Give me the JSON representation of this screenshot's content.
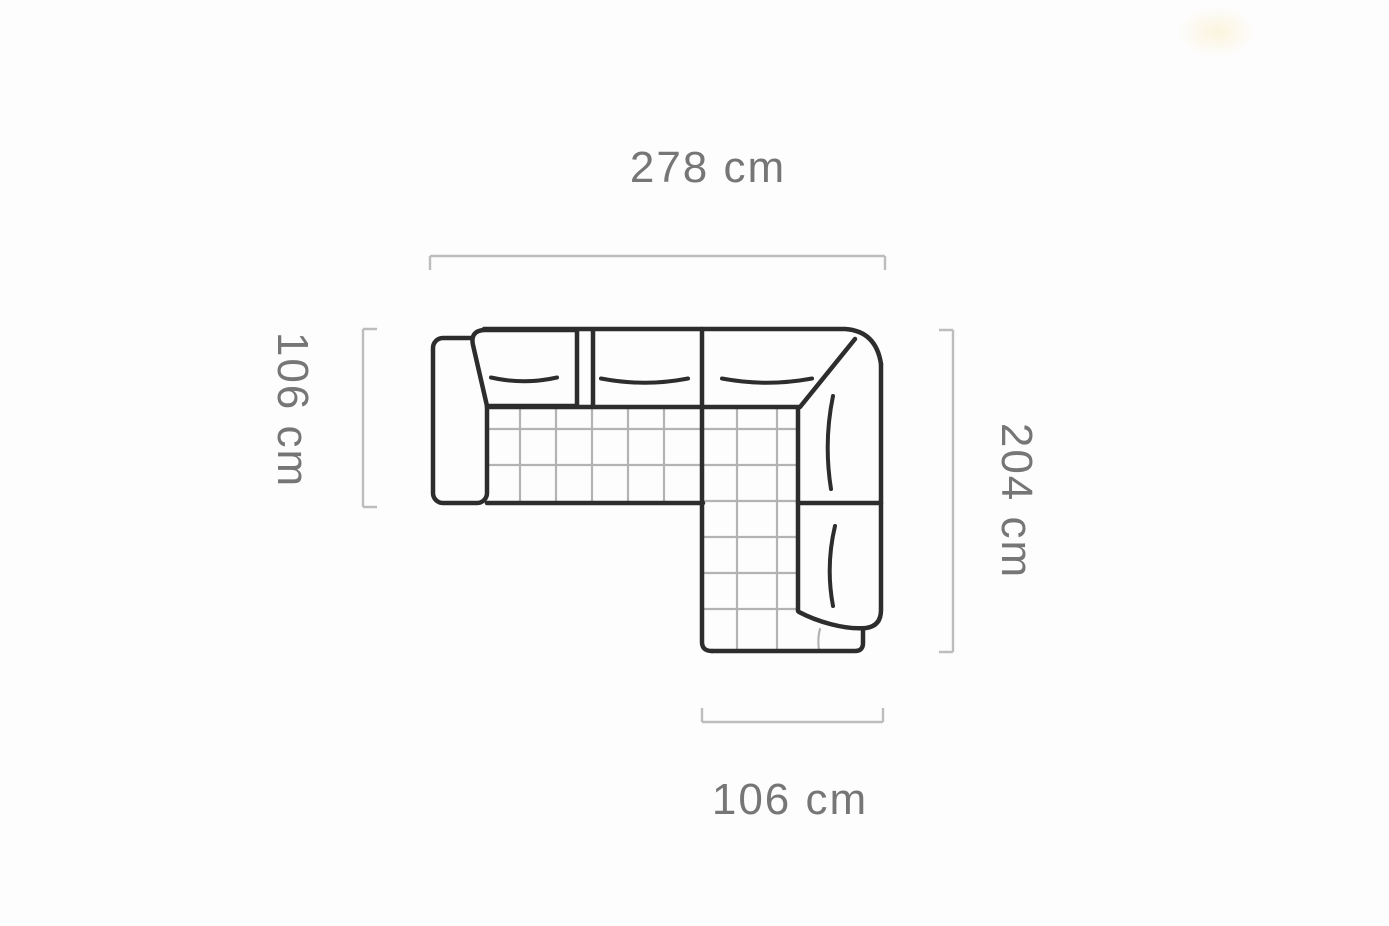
{
  "diagram": {
    "type": "corner-sofa-top-view-dimension-drawing",
    "unit": "cm",
    "dimensions": {
      "top": {
        "value": "278",
        "label": "278 cm"
      },
      "left": {
        "value": "106",
        "label": "106 cm"
      },
      "right": {
        "value": "204",
        "label": "204 cm"
      },
      "bottom": {
        "value": "106",
        "label": "106 cm"
      }
    },
    "colors": {
      "background": "#fdfdfd",
      "outline": "#2d2d2d",
      "quilt_line": "#b3b3b3",
      "dimension_line": "#bdbdbd",
      "label_text": "#767676"
    }
  }
}
